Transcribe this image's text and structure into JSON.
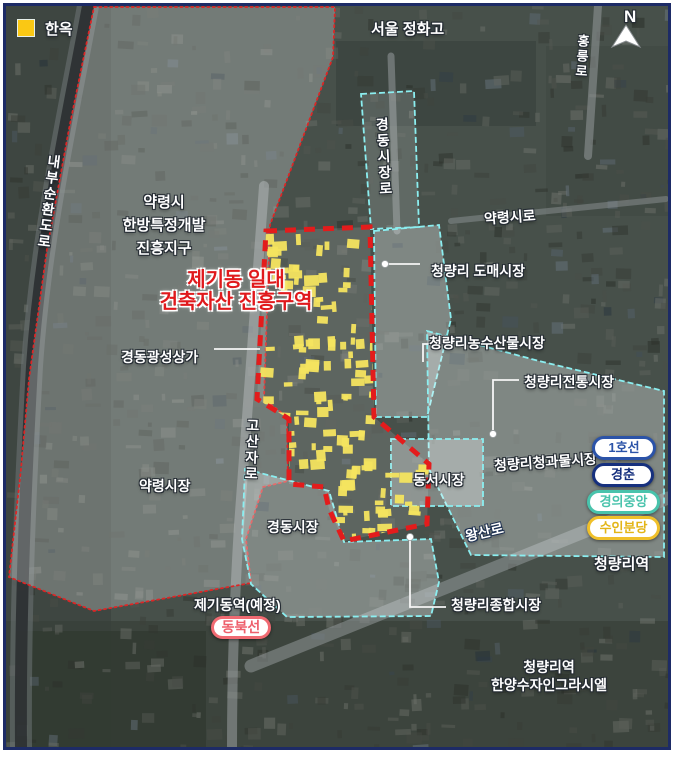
{
  "legend": {
    "hanok": "한옥"
  },
  "compass": {
    "north": "N"
  },
  "district_title": {
    "line1": "제기동 일대",
    "line2": "건축자산 진흥구역"
  },
  "zones": {
    "yangnyeongsi_line1": "약령시",
    "yangnyeongsi_line2": "한방특정개발",
    "yangnyeongsi_line3": "진흥지구"
  },
  "roads": {
    "naebu_sunhwan": "내부순환도로",
    "gyeongdong_sijang_ro": "경동시장로",
    "hongneung_ro": "홍릉로",
    "yangnyeongsi_ro": "약령시로",
    "gosanja_ro": "고산자로",
    "wangsan_ro": "왕산로"
  },
  "places": {
    "school": "서울 정화고",
    "gyeongdong_gwangseong": "경동광성상가",
    "cheongnyangni_domae": "청량리 도매시장",
    "nongsusanmul": "청량리농수산물시장",
    "jeontong": "청량리전통시장",
    "cheonggwamul": "청량리청과물시장",
    "dongseo": "동서시장",
    "gyeongdong_market": "경동시장",
    "yangnyeong_market": "약령시장",
    "jonghap": "청량리종합시장",
    "hanyang_line1": "청량리역",
    "hanyang_line2": "한양수자인그라시엘"
  },
  "stations": {
    "jegidong": "제기동역(예정)",
    "dongbuk_line": "동북선",
    "cheongnyangni": "청량리역"
  },
  "transit_lines": [
    {
      "label": "1호선",
      "color": "#2b53a8"
    },
    {
      "label": "경춘",
      "color": "#16307e"
    },
    {
      "label": "경의중앙",
      "color": "#49c3ac"
    },
    {
      "label": "수인분당",
      "color": "#f0c02a"
    }
  ],
  "colors": {
    "promotion_boundary_red": "#e31c1c",
    "yangnyeong_dotted_red": "#dc2626",
    "market_boundary_cyan": "#8beef0",
    "hanok_fill_yellow": "#f4e45f",
    "legend_yellow": "#fac814",
    "frame_navy": "#1d2b66"
  }
}
